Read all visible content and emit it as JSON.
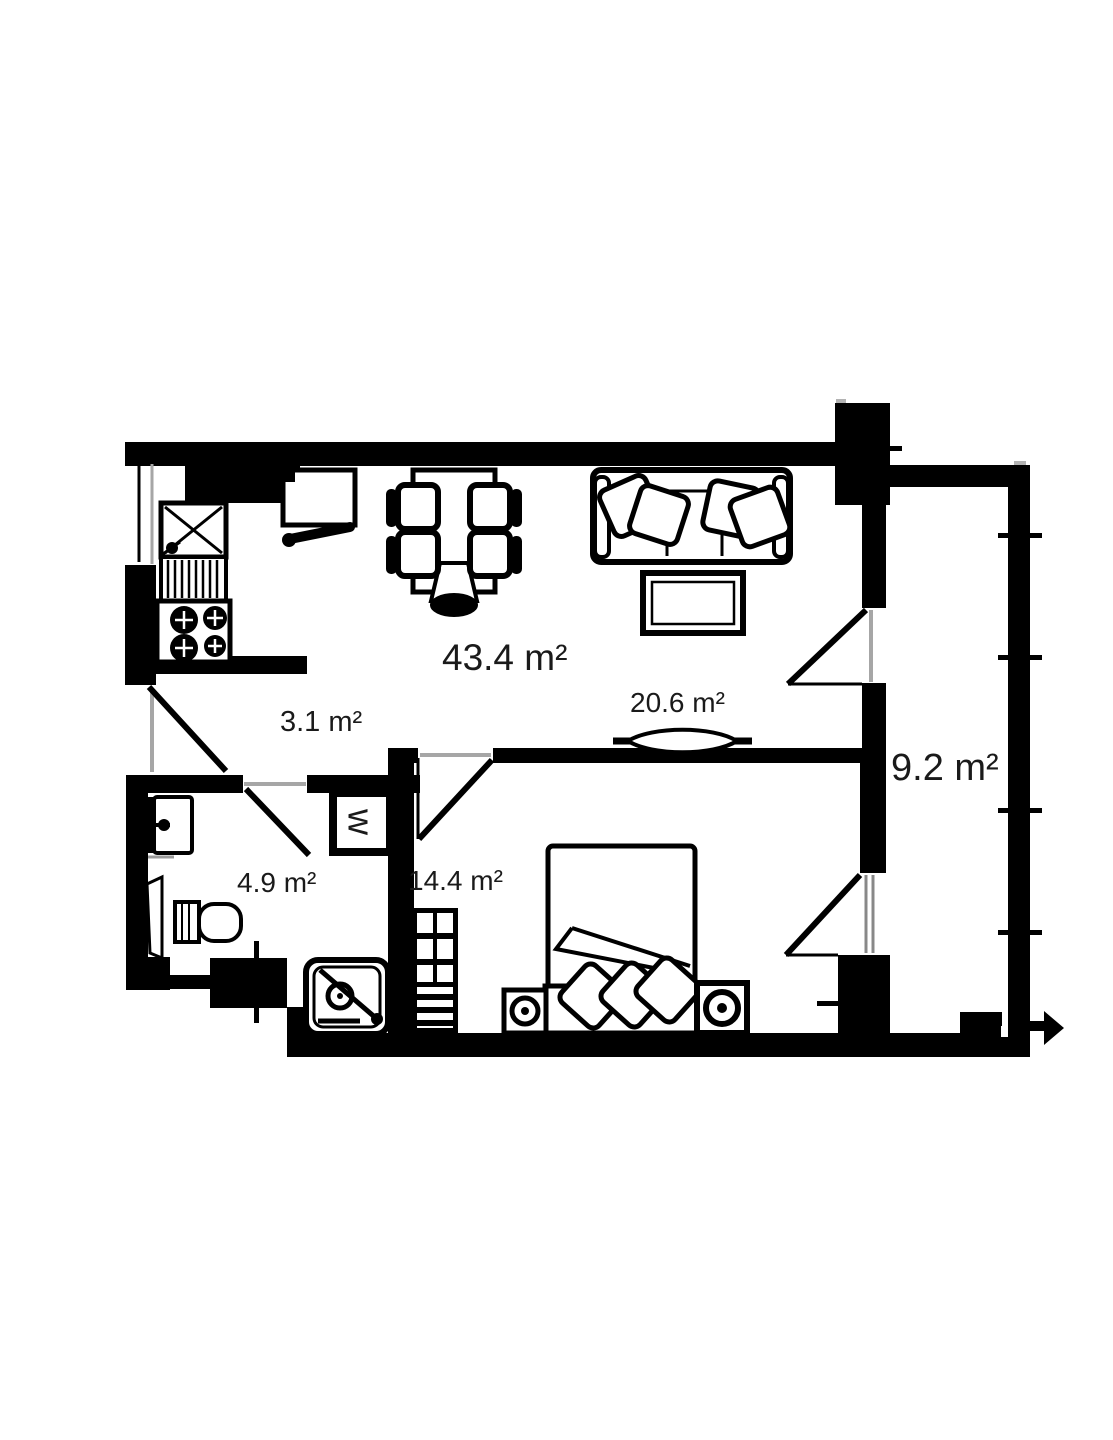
{
  "plan": {
    "rooms": [
      {
        "id": "living-dining-kitchen",
        "label": "43.4 m²"
      },
      {
        "id": "hallway",
        "label": "3.1 m²"
      },
      {
        "id": "living-area",
        "label": "20.6 m²"
      },
      {
        "id": "balcony",
        "label": "9.2 m²"
      },
      {
        "id": "bathroom",
        "label": "4.9 m²"
      },
      {
        "id": "bedroom",
        "label": "14.4 m²"
      }
    ],
    "appliances": {
      "washer_label": "w"
    },
    "icons": [
      "sink-icon",
      "stove-icon",
      "dining-table-icon",
      "chair-icon",
      "sofa-icon",
      "pillow-icon",
      "coffee-table-icon",
      "tv-icon",
      "bed-icon",
      "nightstand-icon",
      "wardrobe-icon",
      "washbasin-icon",
      "toilet-icon",
      "shower-icon",
      "door-swing-icon",
      "window-icon",
      "railing-tick-icon",
      "entry-arrow-icon"
    ],
    "colors": {
      "walls": "#000000",
      "background": "#ffffff",
      "labels": "#1a1a1a",
      "openings": "#a6a6a6"
    }
  }
}
